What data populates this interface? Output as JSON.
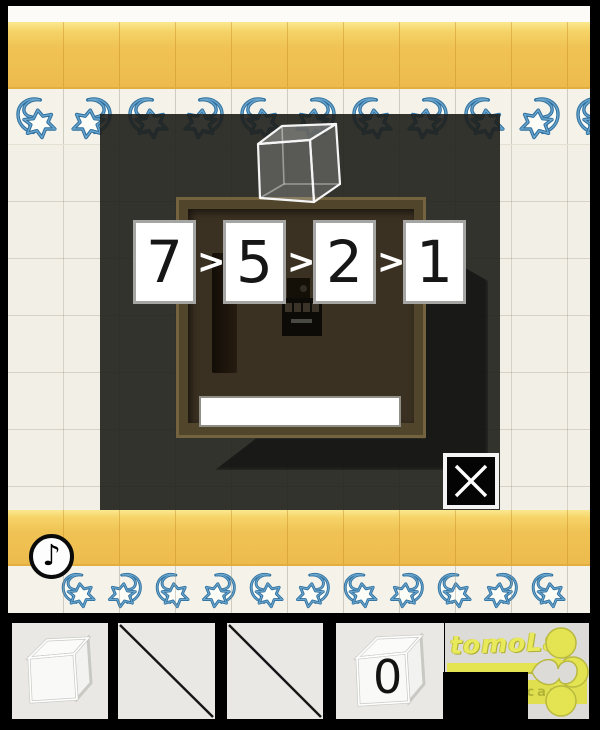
{
  "popup": {
    "sequence_cards": [
      "7",
      "5",
      "2",
      "1"
    ],
    "separator": ">"
  },
  "sound_button": {
    "icon": "♪"
  },
  "inventory": {
    "zero_cube_label": "0",
    "logo_title": "tomoLa",
    "logo_subtitle": "escape"
  },
  "colors": {
    "wall_tile": "#f2efe6",
    "accent_yellow": "#f0c351",
    "pattern_blue": "#4e93c4",
    "popup_panel": "#32302c",
    "box_frame": "#51452c",
    "box_interior": "#3b3122",
    "logo_yellow": "#e4e452"
  }
}
